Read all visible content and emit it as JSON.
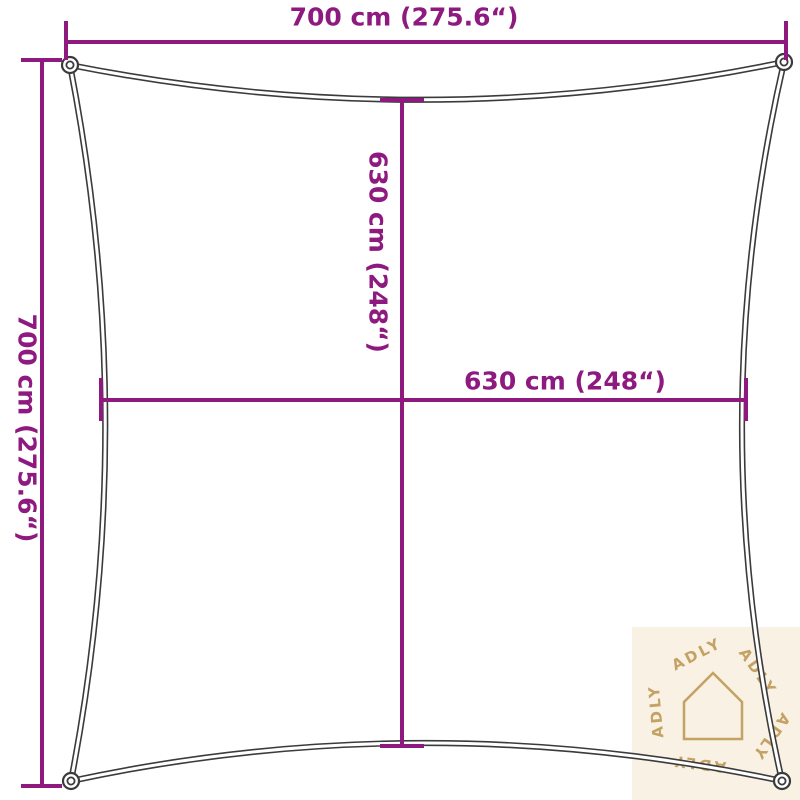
{
  "diagram": {
    "type": "product-dimension-diagram",
    "subject": "square shade sail outline with corner rings",
    "dimensions": {
      "top_width": "700 cm (275.6“)",
      "left_height": "700 cm (275.6“)",
      "inner_height": "630 cm (248“)",
      "inner_width": "630 cm (248“)"
    }
  },
  "watermark": {
    "brand": "ADLY",
    "icon": "house-outline-icon"
  },
  "colors": {
    "dimension_accent": "#8e1a7f",
    "sail_outline": "#3b3b3b",
    "watermark_bg": "#f8f1e4",
    "watermark_fg": "#c4a263"
  }
}
